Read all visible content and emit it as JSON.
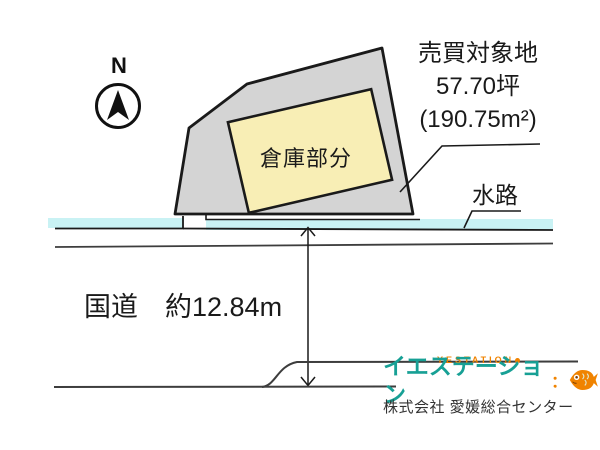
{
  "plan": {
    "north_label": "N",
    "property": {
      "title": "売買対象地",
      "area_tsubo": "57.70坪",
      "area_sqm": "(190.75m²)"
    },
    "warehouse_label": "倉庫部分",
    "waterway_label": "水路",
    "road_label": "国道　約12.84m"
  },
  "branding": {
    "logo_top": "YESTATION",
    "logo_main": "イエステーション",
    "logo_dots": "：",
    "company": "株式会社 愛媛総合センター"
  },
  "colors": {
    "plot_fill": "#d4d4d4",
    "warehouse_fill": "#f8eeb5",
    "waterway_fill": "#c9f2f4",
    "outline": "#1a1a1a",
    "road_line": "#3d3d3d",
    "logo_teal": "#17a095",
    "logo_orange": "#f08300",
    "company_text": "#333333"
  }
}
